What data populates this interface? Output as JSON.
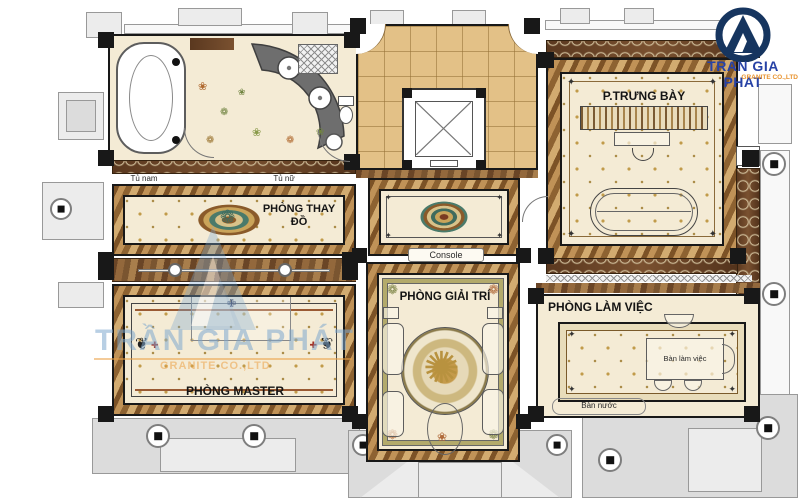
{
  "watermark": {
    "text": "TRẦN GIA PHÁT",
    "subtext": "GRANITE CO.,LTD"
  },
  "logo": {
    "name": "TRAN GIA PHAT",
    "tagline": "GRANITE CO.,LTD"
  },
  "rooms": {
    "display": {
      "label": "P.TRƯNG BÀY"
    },
    "dressing": {
      "label": "PHÒNG THAY ĐỒ"
    },
    "entertainment": {
      "label": "PHÒNG GIẢI TRÍ"
    },
    "master": {
      "label": "PHÒNG MASTER"
    },
    "office": {
      "label": "PHÒNG LÀM VIỆC"
    },
    "hall": {
      "console_label": "Console"
    }
  },
  "furniture": {
    "tu_nam": "Tủ nam",
    "tu_nu": "Tủ nữ",
    "ban_lam_viec": "Bàn làm việc",
    "ban_nuoc": "Bàn nước"
  },
  "glyphs": {
    "flower": "❀",
    "rosette": "❁",
    "corner": "✦",
    "swirl": "❦",
    "sun": "✺",
    "cross": "✚",
    "finial": "✙"
  },
  "colors": {
    "cream": "#f4ebd5",
    "star": "#c19b4a",
    "wood1": "#5e3b22",
    "wall": "#181818",
    "marble1": "#7c5226",
    "marble2": "#c09257",
    "marble3": "#8d6231",
    "marble4": "#d2ab70",
    "tile": "#e3c187",
    "grayFill": "#ececec",
    "grayFill2": "#dcdcdc",
    "grayLine": "#999999",
    "logoBlue": "#16355f",
    "logoText": "#2742a6",
    "orange": "#e8932f",
    "wmBlue": "rgba(125,168,206,0.55)",
    "wmOrange": "rgba(235,160,70,0.55)"
  }
}
